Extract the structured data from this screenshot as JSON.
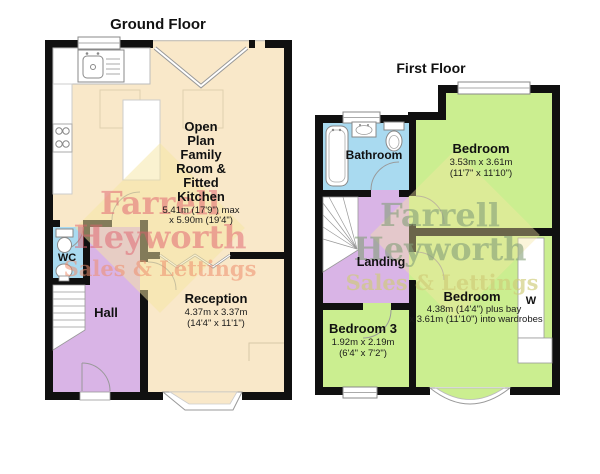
{
  "ground_floor": {
    "title": "Ground Floor",
    "rooms": {
      "open_plan": {
        "lines": [
          "Open",
          "Plan",
          "Family",
          "Room &",
          "Fitted",
          "Kitchen"
        ],
        "dims": [
          "5.41m (17'9\") max",
          "x 5.90m (19'4\")"
        ]
      },
      "wc": {
        "label": "WC"
      },
      "hall": {
        "label": "Hall"
      },
      "reception": {
        "label": "Reception",
        "dims": [
          "4.37m x 3.37m",
          "(14'4\" x 11'1\")"
        ]
      }
    }
  },
  "first_floor": {
    "title": "First Floor",
    "rooms": {
      "bathroom": {
        "label": "Bathroom"
      },
      "bedroom1": {
        "label": "Bedroom",
        "dims": [
          "3.53m x 3.61m",
          "(11'7\" x 11'10\")"
        ]
      },
      "landing": {
        "label": "Landing"
      },
      "bedroom3": {
        "label": "Bedroom 3",
        "dims": [
          "1.92m x 2.19m",
          "(6'4\" x 7'2\")"
        ]
      },
      "bedroom2": {
        "label": "Bedroom",
        "dims": [
          "4.38m (14'4\") plus bay",
          "x 3.61m (11'10\") into wardrobes"
        ]
      },
      "wardrobe": {
        "label": "W"
      }
    }
  },
  "watermark": {
    "line1": "Farrell",
    "line2": "Heyworth",
    "line3": "Sales & Lettings"
  },
  "colors": {
    "wall": "#101010",
    "room_cream": "#f9e8c9",
    "room_purple": "#d9b4e6",
    "room_blue": "#a9daf0",
    "room_green": "#cbee90",
    "watermark_red": "#e0606e",
    "watermark_orange": "#ef8f6e",
    "watermark_green": "#84a07a",
    "watermark_yellow_text": "#cfcc78",
    "watermark_diamond": "#f6e5a2"
  },
  "legend_icons": [
    "sink-icon",
    "hob-icon",
    "toilet-icon",
    "basin-icon",
    "bath-icon",
    "stairs-icon",
    "door-swing-icon",
    "window-icon",
    "bay-window-icon",
    "bifold-door-icon",
    "wardrobe-icon"
  ]
}
